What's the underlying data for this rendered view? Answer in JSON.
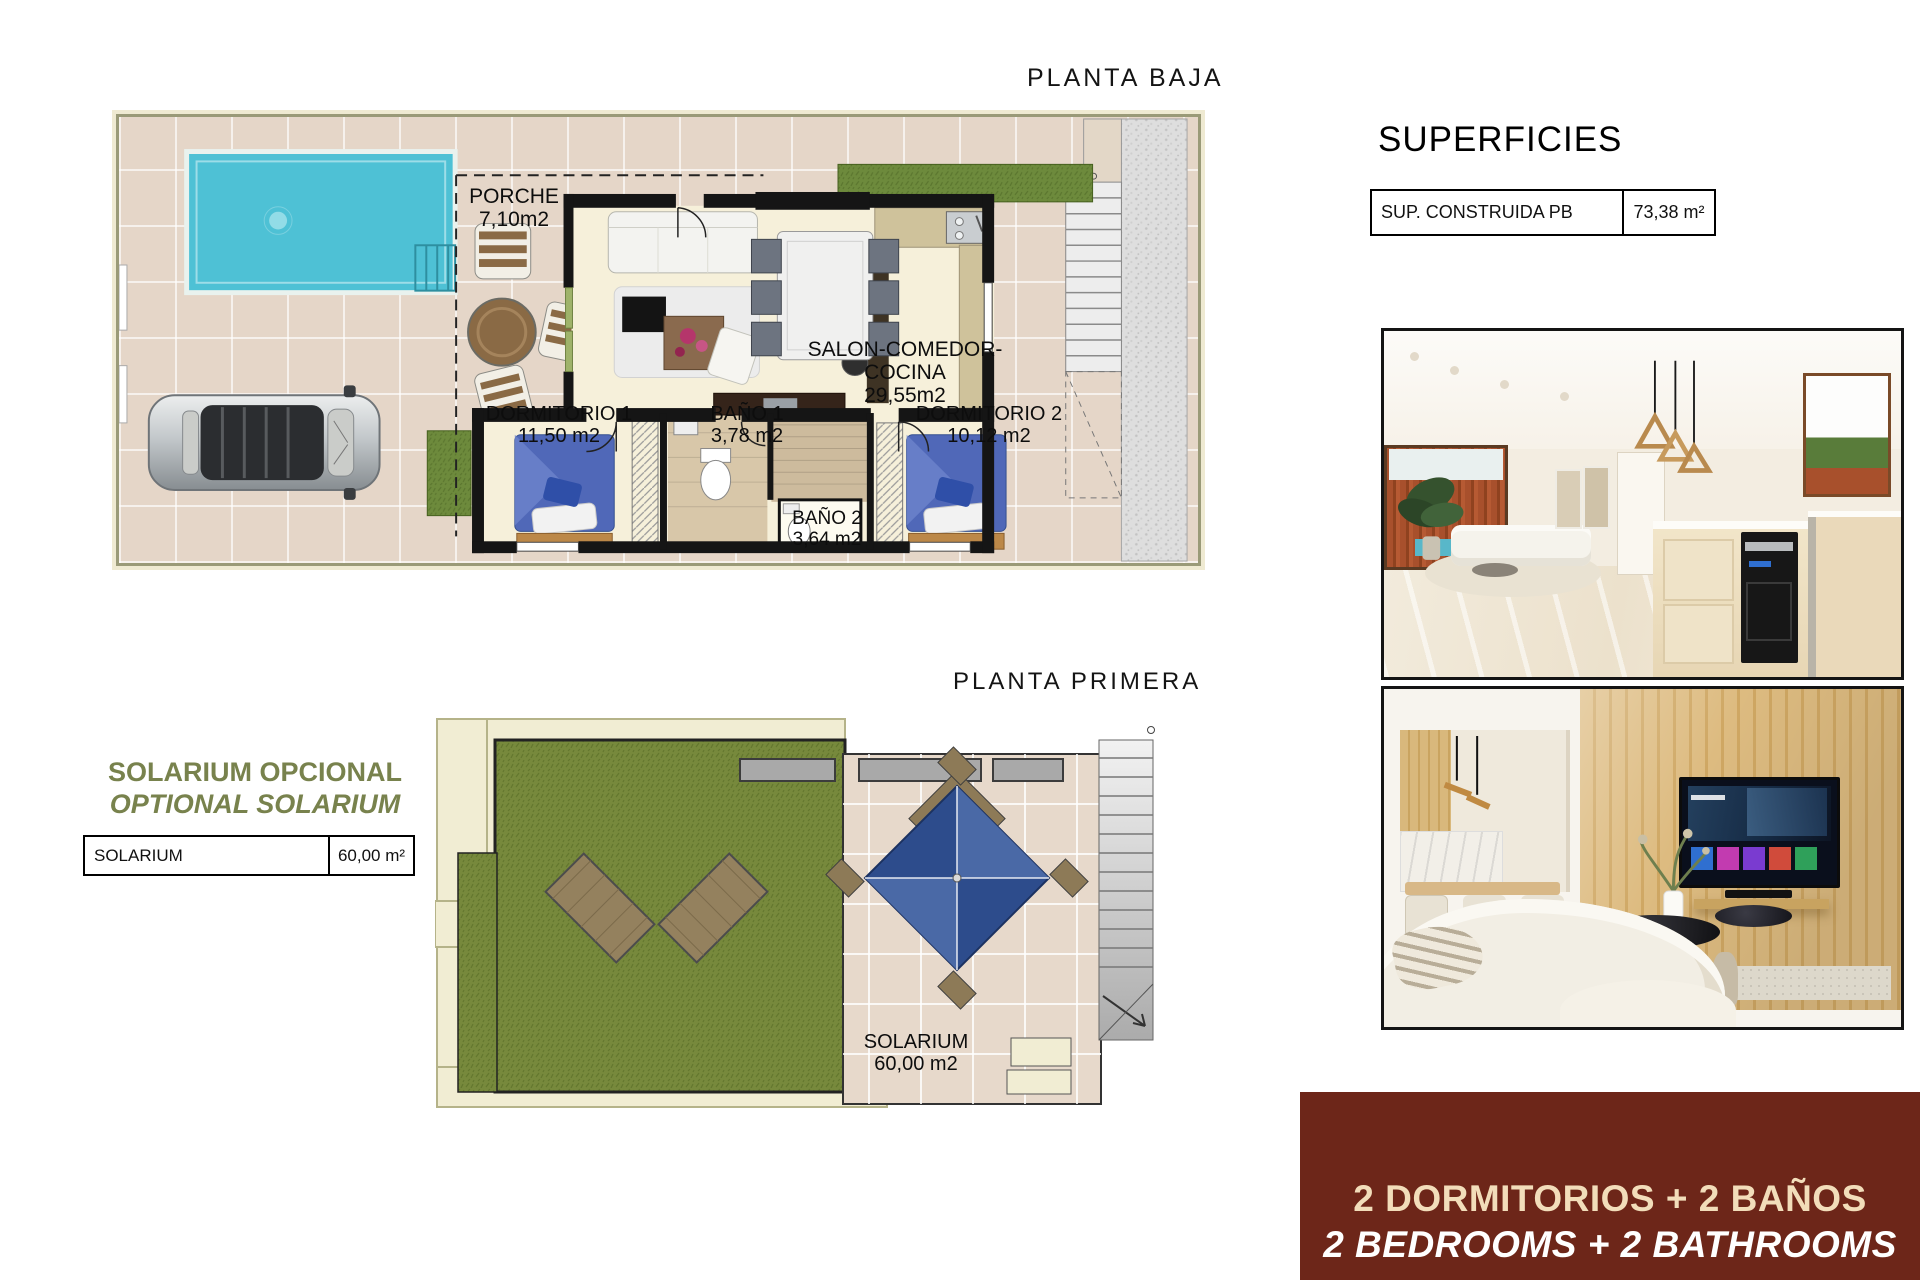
{
  "page": {
    "background": "#ffffff"
  },
  "ground_floor": {
    "title": "PLANTA BAJA",
    "labels": {
      "porche": {
        "name": "PORCHE",
        "area": "7,10m2"
      },
      "salon": {
        "name": "SALON-COMEDOR-COCINA",
        "area": "29,55m2"
      },
      "dormitorio1": {
        "name": "DORMITORIO 1",
        "area": "11,50 m2"
      },
      "bano1": {
        "name": "BAÑO 1",
        "area": "3,78 m2"
      },
      "dormitorio2": {
        "name": "DORMITORIO 2",
        "area": "10,12 m2"
      },
      "bano2": {
        "name": "BAÑO 2",
        "area": "3,64 m2"
      }
    }
  },
  "first_floor": {
    "title": "PLANTA PRIMERA",
    "labels": {
      "solarium": {
        "name": "SOLARIUM",
        "area": "60,00 m2"
      }
    }
  },
  "superficies": {
    "title": "SUPERFICIES",
    "rows": [
      {
        "label": "SUP. CONSTRUIDA PB",
        "value": "73,38 m²"
      }
    ]
  },
  "solarium_note": {
    "line1": "SOLARIUM OPCIONAL",
    "line2": "OPTIONAL SOLARIUM",
    "table": {
      "label": "SOLARIUM",
      "value": "60,00 m²"
    }
  },
  "banner": {
    "line1": "2 DORMITORIOS + 2 BAÑOS",
    "line2": "2 BEDROOMS + 2 BATHROOMS"
  },
  "colors": {
    "accent_olive": "#78824d",
    "banner_bg": "#6d2619",
    "banner_line1": "#f2ddba",
    "banner_line2": "#ffffff",
    "pool": "#4ec1d5",
    "grass": "#75883d",
    "terrace_tile": "#e5d6c8"
  },
  "photos": [
    {
      "name": "kitchen-dining-render"
    },
    {
      "name": "living-room-tv-render"
    }
  ]
}
